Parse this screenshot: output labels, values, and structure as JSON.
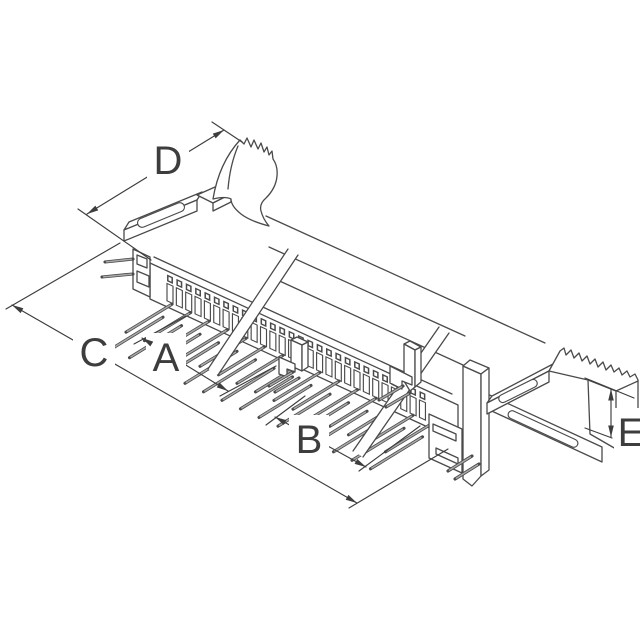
{
  "figure": {
    "kind": "isometric technical line drawing",
    "subject": "Dual-row right-angle board connector with serrated ejector latches at both ends, drawn foreshortened with two break lines",
    "background_color": "#ffffff",
    "line_color": "#4a4a4a",
    "pin_fill_color": "#aba9a7",
    "dimension_color": "#3d3d3d",
    "labels": {
      "A": "A",
      "B": "B",
      "C": "C",
      "D": "D",
      "E": "E"
    },
    "drawing": {
      "contact_slot_count": 28,
      "pin_groups": [
        {
          "columns": 9
        },
        {
          "columns": 6
        }
      ],
      "break_line_count": 2,
      "serrated_latch_pads": 2
    }
  }
}
